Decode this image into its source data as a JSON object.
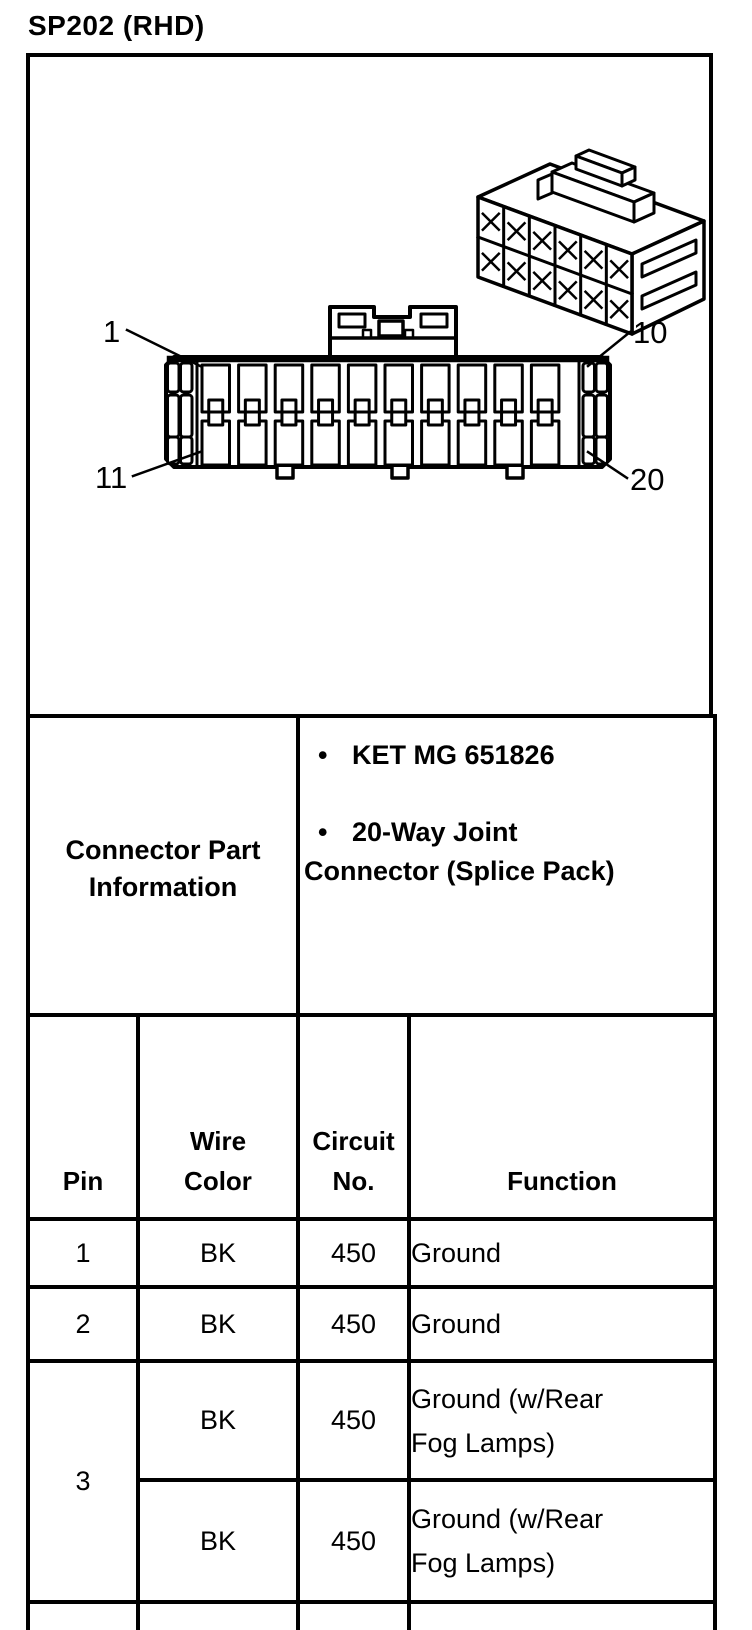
{
  "title": "SP202 (RHD)",
  "colors": {
    "ink": "#000000",
    "paper": "#ffffff"
  },
  "figure": {
    "pin_labels": {
      "top_left": "1",
      "top_right": "10",
      "bottom_left": "11",
      "bottom_right": "20"
    }
  },
  "part_info": {
    "title": "Connector Part Information",
    "items": [
      {
        "bullet": "•",
        "lines": [
          "KET MG 651826"
        ]
      },
      {
        "bullet": "•",
        "lines": [
          "20-Way Joint",
          "Connector (Splice Pack)"
        ]
      }
    ]
  },
  "pin_table": {
    "headers": {
      "pin": "Pin",
      "wire_color_lines": [
        "Wire",
        "Color"
      ],
      "circuit_no_lines": [
        "Circuit",
        "No."
      ],
      "function": "Function"
    },
    "rows": [
      {
        "pin": "1",
        "wire": "BK",
        "circuit": "450",
        "function": "Ground"
      },
      {
        "pin": "2",
        "wire": "BK",
        "circuit": "450",
        "function": "Ground"
      },
      {
        "pin": "3",
        "subrows": [
          {
            "wire": "BK",
            "circuit": "450",
            "function": "Ground (w/Rear Fog Lamps)"
          },
          {
            "wire": "BK",
            "circuit": "450",
            "function": "Ground (w/Rear Fog Lamps)"
          }
        ]
      }
    ]
  }
}
